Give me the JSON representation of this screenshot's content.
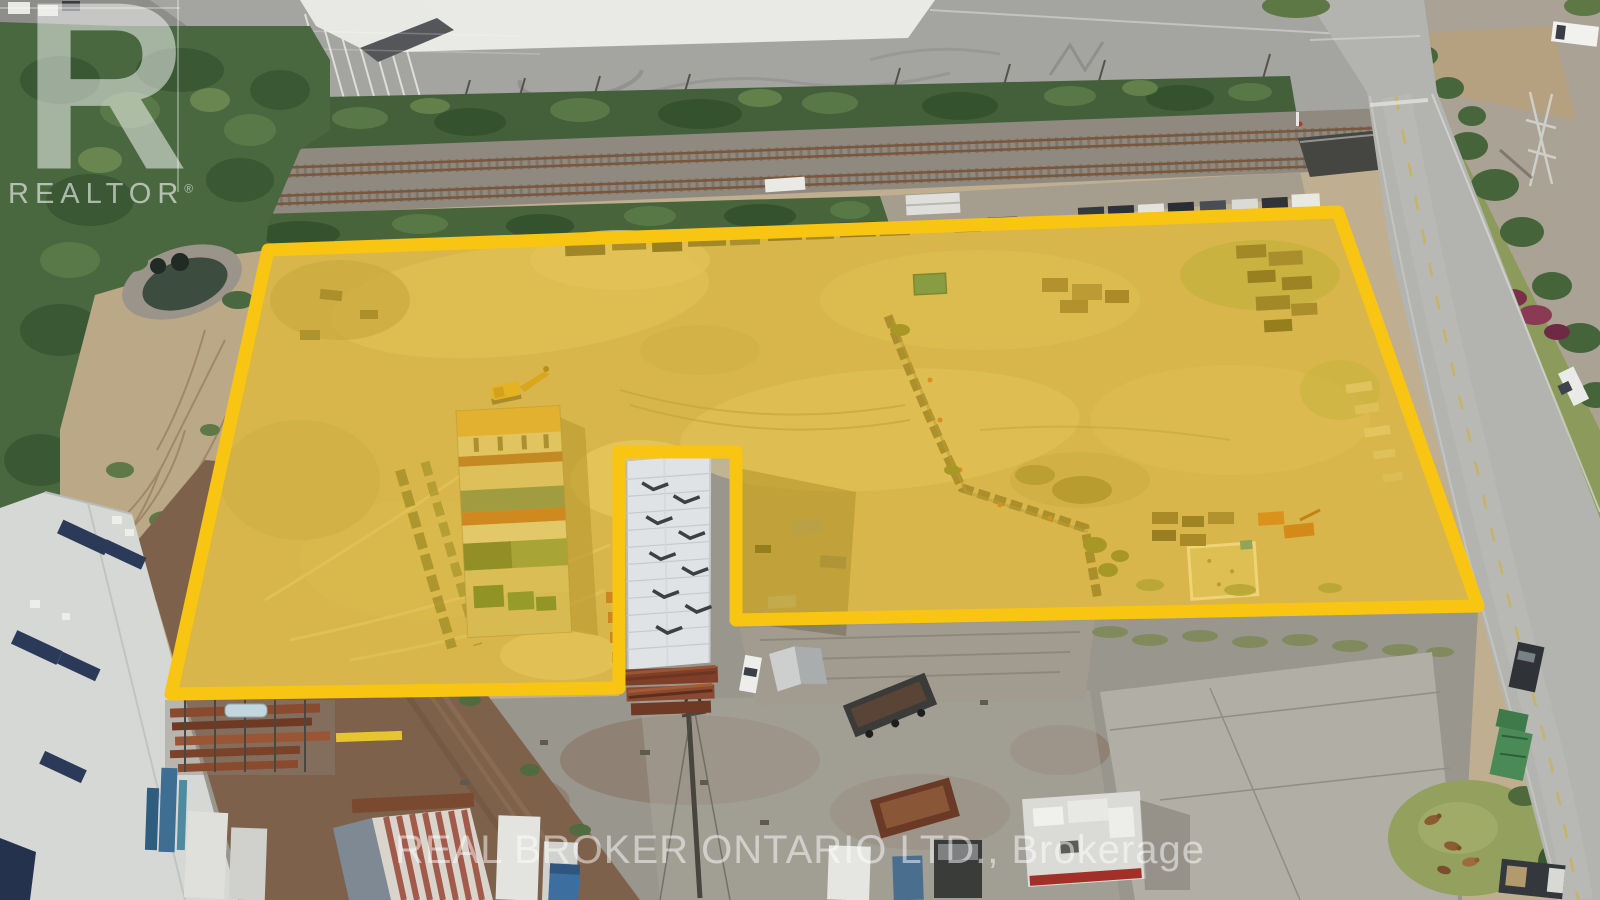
{
  "watermarks": {
    "logo_letter": "R",
    "logo_word": "REALTOR",
    "registered_symbol": "®",
    "footer": "REAL BROKER ONTARIO LTD., Brokerage"
  },
  "parcel": {
    "boundary_color": "#F9C513",
    "fill_color": "rgba(247,196,6,0.45)"
  }
}
